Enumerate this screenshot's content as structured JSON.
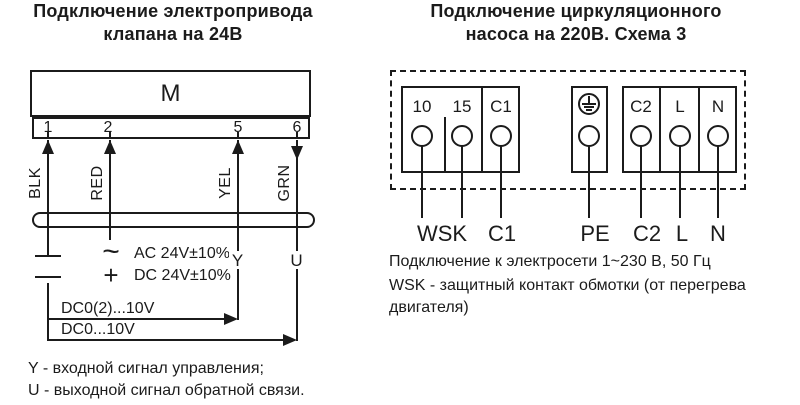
{
  "colors": {
    "ink": "#1b1b1b",
    "bg": "#ffffff"
  },
  "left": {
    "title1": "Подключение электропривода",
    "title2": "клапана на 24В",
    "motor": "M",
    "terminals": [
      "1",
      "2",
      "5",
      "6"
    ],
    "wires": [
      "BLK",
      "RED",
      "YEL",
      "GRN"
    ],
    "ac_sym": "~",
    "ac_text": "AC 24V±10%",
    "dc_sym": "+",
    "dc_text": "DC 24V±10%",
    "y": "Y",
    "u": "U",
    "branch1": "DC0(2)...10V",
    "branch2": "DC0...10V",
    "legend1": "Y - входной сигнал управления;",
    "legend2": "U - выходной сигнал обратной связи."
  },
  "right": {
    "title1": "Подключение циркуляционного",
    "title2": "насоса на 220В. Схема 3",
    "block1": [
      "10",
      "15",
      "C1"
    ],
    "block3": [
      "C2",
      "L",
      "N"
    ],
    "bottom": [
      "WSK",
      "C1",
      "PE",
      "C2",
      "L",
      "N"
    ],
    "note1": "Подключение к электросети 1~230 В, 50 Гц",
    "note2": "WSK - защитный контакт обмотки (от перегрева",
    "note3": "двигателя)"
  }
}
